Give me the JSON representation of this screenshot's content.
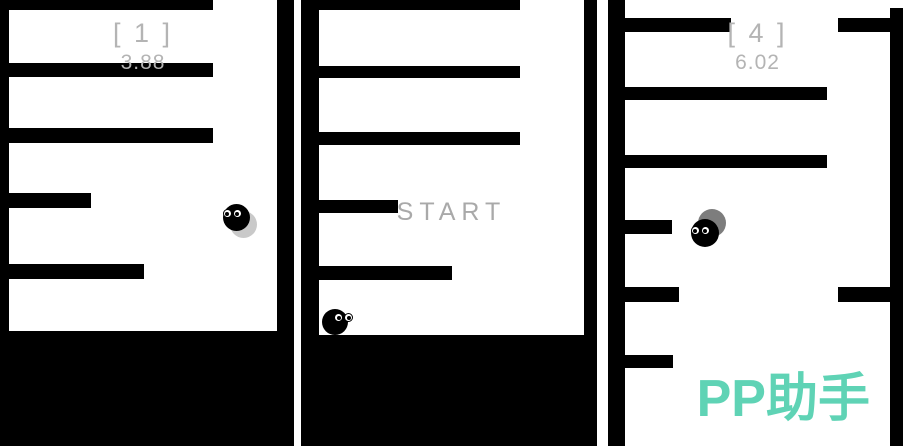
{
  "meta": {
    "description": "Three-panel composite screenshot of a minimalist falling-ball maze game",
    "background": "#ffffff"
  },
  "colors": {
    "platform": "#000000",
    "hud_text": "#b4b4b4",
    "start_text": "#a9a9a9",
    "watermark_teal": "#5fd3b5",
    "ball": "#000000",
    "shadow_light": "#c9c9c9",
    "shadow_dark": "#7d7d7d"
  },
  "panels": [
    {
      "title": "level-1-screen",
      "level_label": "[ 1 ]",
      "score": "3.88",
      "geometry": {
        "x": 0,
        "w": 294,
        "walls": [
          {
            "name": "left-wall",
            "x": 0,
            "y": 0,
            "w": 9,
            "h": 446
          },
          {
            "name": "right-wall",
            "x": 277,
            "y": 0,
            "w": 17,
            "h": 340
          }
        ],
        "bars": [
          {
            "x": 0,
            "y": 0,
            "w": 213,
            "h": 10
          },
          {
            "x": 0,
            "y": 63,
            "w": 213,
            "h": 14
          },
          {
            "x": 0,
            "y": 128,
            "w": 213,
            "h": 15
          },
          {
            "x": 0,
            "y": 193,
            "w": 91,
            "h": 15
          },
          {
            "x": 0,
            "y": 264,
            "w": 144,
            "h": 15
          }
        ],
        "floor": {
          "x": 0,
          "y": 331,
          "w": 294,
          "h": 115
        },
        "ball": {
          "cx": 236,
          "cy": 217,
          "r": 13.5,
          "shadow": {
            "dx": 7,
            "dy": 7,
            "color": "#c9c9c9"
          },
          "eyes": {
            "dx": -4,
            "dy": -4,
            "pupil": "left"
          }
        }
      }
    },
    {
      "title": "start-screen",
      "start_label": "START",
      "geometry": {
        "x": 301,
        "w": 296,
        "walls": [
          {
            "name": "left-wall",
            "x": 0,
            "y": 0,
            "w": 18,
            "h": 446
          },
          {
            "name": "right-wall",
            "x": 283,
            "y": 0,
            "w": 13,
            "h": 340
          }
        ],
        "bars": [
          {
            "x": 0,
            "y": 0,
            "w": 219,
            "h": 10
          },
          {
            "x": 0,
            "y": 66,
            "w": 219,
            "h": 12
          },
          {
            "x": 0,
            "y": 132,
            "w": 219,
            "h": 13
          },
          {
            "x": 0,
            "y": 200,
            "w": 97,
            "h": 13
          },
          {
            "x": 0,
            "y": 266,
            "w": 151,
            "h": 14
          }
        ],
        "floor": {
          "x": 0,
          "y": 335,
          "w": 296,
          "h": 111
        },
        "ball": {
          "cx": 34,
          "cy": 322,
          "r": 13,
          "eyes": {
            "dx": 8,
            "dy": -5,
            "pupil": "right"
          }
        }
      }
    },
    {
      "title": "level-4-screen",
      "level_label": "[ 4 ]",
      "score": "6.02",
      "watermark": "PP助手",
      "geometry": {
        "x": 608,
        "w": 295,
        "walls": [
          {
            "name": "left-wall",
            "x": 0,
            "y": 0,
            "w": 17,
            "h": 446
          },
          {
            "name": "right-wall",
            "x": 282,
            "y": 8,
            "w": 13,
            "h": 438
          }
        ],
        "bars": [
          {
            "x": 0,
            "y": 18,
            "w": 123,
            "h": 14
          },
          {
            "x": 0,
            "y": 87,
            "w": 219,
            "h": 13
          },
          {
            "x": 0,
            "y": 155,
            "w": 219,
            "h": 13
          },
          {
            "x": 0,
            "y": 220,
            "w": 64,
            "h": 14
          },
          {
            "x": 0,
            "y": 287,
            "w": 71,
            "h": 15
          },
          {
            "x": 0,
            "y": 355,
            "w": 65,
            "h": 13
          },
          {
            "x": 230,
            "y": 18,
            "w": 65,
            "h": 14
          },
          {
            "x": 230,
            "y": 287,
            "w": 65,
            "h": 15
          }
        ],
        "ball": {
          "cx": 97,
          "cy": 233,
          "r": 14,
          "shadow": {
            "dx": 7,
            "dy": -10,
            "color": "#7d7d7d"
          },
          "eyes": {
            "dx": -5,
            "dy": -3,
            "pupil": "left"
          }
        }
      }
    }
  ]
}
